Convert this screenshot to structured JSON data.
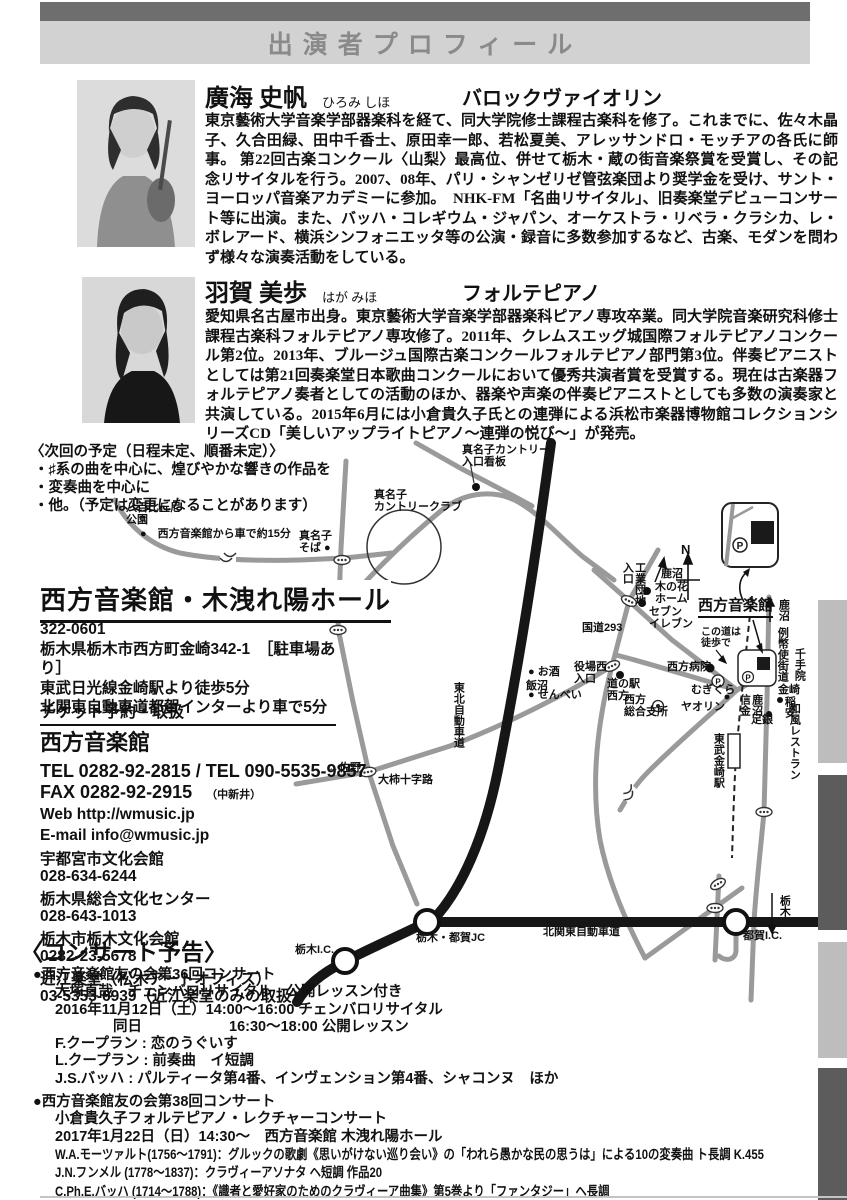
{
  "colors": {
    "header_bar": "#6e6e6e",
    "header_band": "#d2d2d2",
    "title_text": "#8a8a8a",
    "tab_light": "#bdbdbd",
    "tab_dark": "#5c5c5c",
    "expressway": "#161616",
    "road": "#9a9a9a"
  },
  "header": {
    "title": "出演者プロフィール"
  },
  "profiles": [
    {
      "name": "廣海 史帆",
      "kana": "ひろみ しほ",
      "instrument": "バロックヴァイオリン",
      "bio": "東京藝術大学音楽学部器楽科を経て、同大学院修士課程古楽科を修了。これまでに、佐々木晶子、久合田緑、田中千香士、原田幸一郎、若松夏美、アレッサンドロ・モッチアの各氏に師事。 第22回古楽コンクール〈山梨〉最高位、併せて栃木・蔵の街音楽祭賞を受賞し、その記念リサイタルを行う。2007、08年、パリ・シャンゼリゼ管弦楽団より奨学金を受け、サント・ヨーロッパ音楽アカデミーに参加。　NHK-FM「名曲リサイタル」、旧奏楽堂デビューコンサート等に出演。また、バッハ・コレギウム・ジャパン、オーケストラ・リベラ・クラシカ、レ・ボレアード、横浜シンフォニエッタ等の公演・録音に多数参加するなど、古楽、モダンを問わず様々な演奏活動をしている。"
    },
    {
      "name": "羽賀 美歩",
      "kana": "はが みほ",
      "instrument": "フォルテピアノ",
      "bio": "愛知県名古屋市出身。東京藝術大学音楽学部器楽科ピアノ専攻卒業。同大学院音楽研究科修士課程古楽科フォルテピアノ専攻修了。2011年、クレムスエッグ城国際フォルテピアノコンクール第2位。2013年、ブルージュ国際古楽コンクールフォルテピアノ部門第3位。伴奏ピアニストとしては第21回奏楽堂日本歌曲コンクールにおいて優秀共演者賞を受賞する。現在は古楽器フォルテピアノ奏者としての活動のほか、器楽や声楽の伴奏ピアニストとしても多数の演奏家と共演している。2015年6月には小倉貴久子氏との連弾による浜松市楽器博物館コレクションシリーズCD「美しいアップライトピアノ～連弾の悦び～」が発売。"
    }
  ],
  "next_plan": {
    "title": "〈次回の予定（日程未定、順番未定）〉",
    "items": [
      "・♯系の曲を中心に、煌びやかな響きの作品を",
      "・変奏曲を中心に",
      "・他。（予定は変更になることがあります）"
    ]
  },
  "venue": {
    "name": "西方音楽館・木洩れ陽ホール",
    "postal": "322-0601",
    "address": "栃木県栃木市西方町金崎342-1　［駐車場あり］",
    "access1": "東武日光線金崎駅より徒歩5分",
    "access2": "北関東自動車道都賀インターより車で5分"
  },
  "tickets": {
    "heading": "チケット予約・取扱",
    "main_name": "西方音楽館",
    "tel_line": "TEL 0282-92-2815 / TEL 090-5535-9857",
    "fax_line": "FAX 0282-92-2915",
    "fax_note": "（中新井）",
    "web_line": "Web  http://wmusic.jp",
    "email_line": "E-mail  info@wmusic.jp",
    "outlets": [
      {
        "name": "宇都宮市文化会館",
        "tel": "028-634-6244"
      },
      {
        "name": "栃木県総合文化センター",
        "tel": "028-643-1013"
      },
      {
        "name": "栃木市栃木文化会館",
        "tel": "0282-23-5678"
      },
      {
        "name": "近江楽堂（松木アートオフィス）",
        "tel": "03-5353-6939（近江楽堂のみの取扱）"
      }
    ]
  },
  "announcements": {
    "heading": "〈コンサート予告〉",
    "concerts": [
      {
        "title": "●西方音楽館友の会第36回コンサート",
        "lines": [
          "大塚直哉　チェンバロリサイタル　公開レッスン付き",
          "2016年11月12日（土）14:00～16:00 チェンバロリサイタル",
          "　　　　同日　　　　　　16:30～18:00 公開レッスン",
          "F.クープラン : 恋のうぐいす",
          "L.クープラン : 前奏曲　イ短調",
          "J.S.バッハ : パルティータ第4番、インヴェンション第4番、シャコンヌ　ほか"
        ]
      },
      {
        "title": "●西方音楽館友の会第38回コンサート",
        "lines": [
          "小倉貴久子フォルテピアノ・レクチャーコンサート",
          "2017年1月22日（日）14:30～　西方音楽館 木洩れ陽ホール",
          "W.A.モーツァルト(1756～1791)：グルックの歌劇《思いがけない巡り会い》の「われら愚かな民の思うは」による10の変奏曲 ト長調 K.455",
          "J.N.フンメル (1778～1837)：クラヴィーアソナタ ヘ短調 作品20",
          "C.Ph.E.バッハ (1714～1788)：《識者と愛好家のためのクラヴィーア曲集》第5巻より「ファンタジー」ヘ長調",
          "L.v.ベートーヴェン(1770～1827)：クラヴィーアソナタ 二短調 作品31-2《テンペスト》他"
        ]
      }
    ]
  },
  "map": {
    "parking": "P",
    "labels": [
      {
        "id": "manago-cc-sign",
        "x": 462,
        "y": 444,
        "t": "真名子カントリー\n入口看板"
      },
      {
        "id": "manago-cc",
        "x": 374,
        "y": 489,
        "t": "真名子\nカントリークラブ"
      },
      {
        "id": "yaohi-park",
        "x": 126,
        "y": 502,
        "t": "八百比丘尼\n公園"
      },
      {
        "id": "drive-note",
        "x": 140,
        "y": 528,
        "t": "●　西方音楽館から車で約15分"
      },
      {
        "id": "manago-soba",
        "x": 299,
        "y": 530,
        "t": "真名子\nそば ●"
      },
      {
        "id": "route-293",
        "x": 582,
        "y": 622,
        "t": "国道293"
      },
      {
        "id": "kogyo-danchi",
        "x": 621,
        "y": 562,
        "v": true,
        "t": "工業団地\n入口"
      },
      {
        "id": "kanuma-n",
        "x": 661,
        "y": 568,
        "t": "鹿沼"
      },
      {
        "id": "konohana",
        "x": 655,
        "y": 581,
        "t": "木の花\nホーム"
      },
      {
        "id": "seven-eleven",
        "x": 649,
        "y": 606,
        "t": "セブン\nイレブン"
      },
      {
        "id": "compass-n",
        "x": 681,
        "y": 543,
        "size": 13,
        "t": "N"
      },
      {
        "id": "ongakukan",
        "x": 698,
        "y": 598,
        "cls": "hall",
        "t": "西方音楽館"
      },
      {
        "id": "konomichi",
        "x": 701,
        "y": 627,
        "size": 10,
        "t": "この道は\n徒歩で"
      },
      {
        "id": "hospital",
        "x": 667,
        "y": 661,
        "t": "西方病院"
      },
      {
        "id": "mugikura",
        "x": 691,
        "y": 684,
        "t": "むぎくら"
      },
      {
        "id": "yaorin",
        "x": 681,
        "y": 701,
        "t": "ヤオリン"
      },
      {
        "id": "shisho",
        "x": 624,
        "y": 694,
        "t": "西方\n総合支所"
      },
      {
        "id": "michinoeki",
        "x": 607,
        "y": 678,
        "t": "道の駅\n西方"
      },
      {
        "id": "yakuba",
        "x": 574,
        "y": 661,
        "t": "役場西\n入口"
      },
      {
        "id": "osake",
        "x": 528,
        "y": 666,
        "t": "● お酒"
      },
      {
        "id": "iinuma",
        "x": 526,
        "y": 680,
        "t": "飯沼"
      },
      {
        "id": "senbei",
        "x": 528,
        "y": 689,
        "t": "● せんべい"
      },
      {
        "id": "tohoku-exp",
        "x": 452,
        "y": 682,
        "v": true,
        "t": "東北自動車道"
      },
      {
        "id": "shinkin",
        "x": 738,
        "y": 694,
        "v": true,
        "t": "鹿沼\n信金"
      },
      {
        "id": "kanasaki",
        "x": 778,
        "y": 684,
        "t": "金崎"
      },
      {
        "id": "inayasu",
        "x": 783,
        "y": 696,
        "v": true,
        "t": "稲安"
      },
      {
        "id": "wafu",
        "x": 788,
        "y": 703,
        "v": true,
        "t": "和風レストラン"
      },
      {
        "id": "ashigin",
        "x": 751,
        "y": 714,
        "t": "足銀"
      },
      {
        "id": "senjuin",
        "x": 793,
        "y": 648,
        "v": true,
        "t": "千手院"
      },
      {
        "id": "reiheishi",
        "x": 776,
        "y": 627,
        "v": true,
        "t": "例幣使街道"
      },
      {
        "id": "kanuma-e",
        "x": 777,
        "y": 599,
        "v": true,
        "t": "鹿沼"
      },
      {
        "id": "tobu-sta",
        "x": 712,
        "y": 733,
        "v": true,
        "t": "東武金崎駅"
      },
      {
        "id": "tochigi-s",
        "x": 778,
        "y": 895,
        "v": true,
        "t": "栃木"
      },
      {
        "id": "sano",
        "x": 328,
        "y": 762,
        "t": "←佐野"
      },
      {
        "id": "okaki-jyujiro",
        "x": 378,
        "y": 774,
        "t": "大柿十字路"
      },
      {
        "id": "tochigi-tsuga-jc",
        "x": 416,
        "y": 932,
        "t": "栃木・都賀JC"
      },
      {
        "id": "kitakanto-expwy",
        "x": 543,
        "y": 926,
        "t": "北関東自動車道"
      },
      {
        "id": "tsuga-ic",
        "x": 743,
        "y": 930,
        "t": "都賀I.C."
      },
      {
        "id": "tochigi-ic",
        "x": 295,
        "y": 944,
        "t": "栃木I.C."
      }
    ]
  }
}
